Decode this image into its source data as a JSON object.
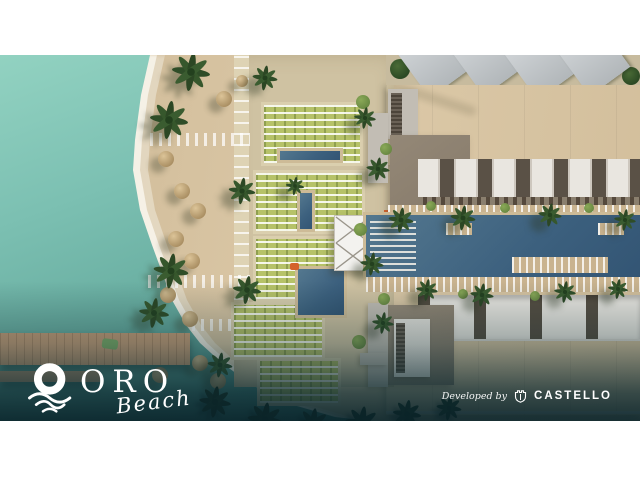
{
  "branding": {
    "logo": {
      "title": "ORO",
      "subtitle": "Beach",
      "icon": "sun-over-waves-icon"
    },
    "developer_credit": {
      "label": "Developed by",
      "name": "CASTELLO",
      "icon": "castello-castle-shield-icon"
    }
  },
  "palette": {
    "sea_turquoise": "#7cc0b2",
    "sea_deep": "#285e60",
    "surf_foam": "#f8f4ea",
    "beach_sand": "#d6c2a0",
    "lawn_green": "#b6c268",
    "pool_blue": "#3c607e",
    "building_white": "#eceae5",
    "annex_brown": "#8a7e6e",
    "pier_wood": "#c99f79",
    "vignette_teal": "#0e2d34",
    "overlay_text": "#ffffff"
  }
}
